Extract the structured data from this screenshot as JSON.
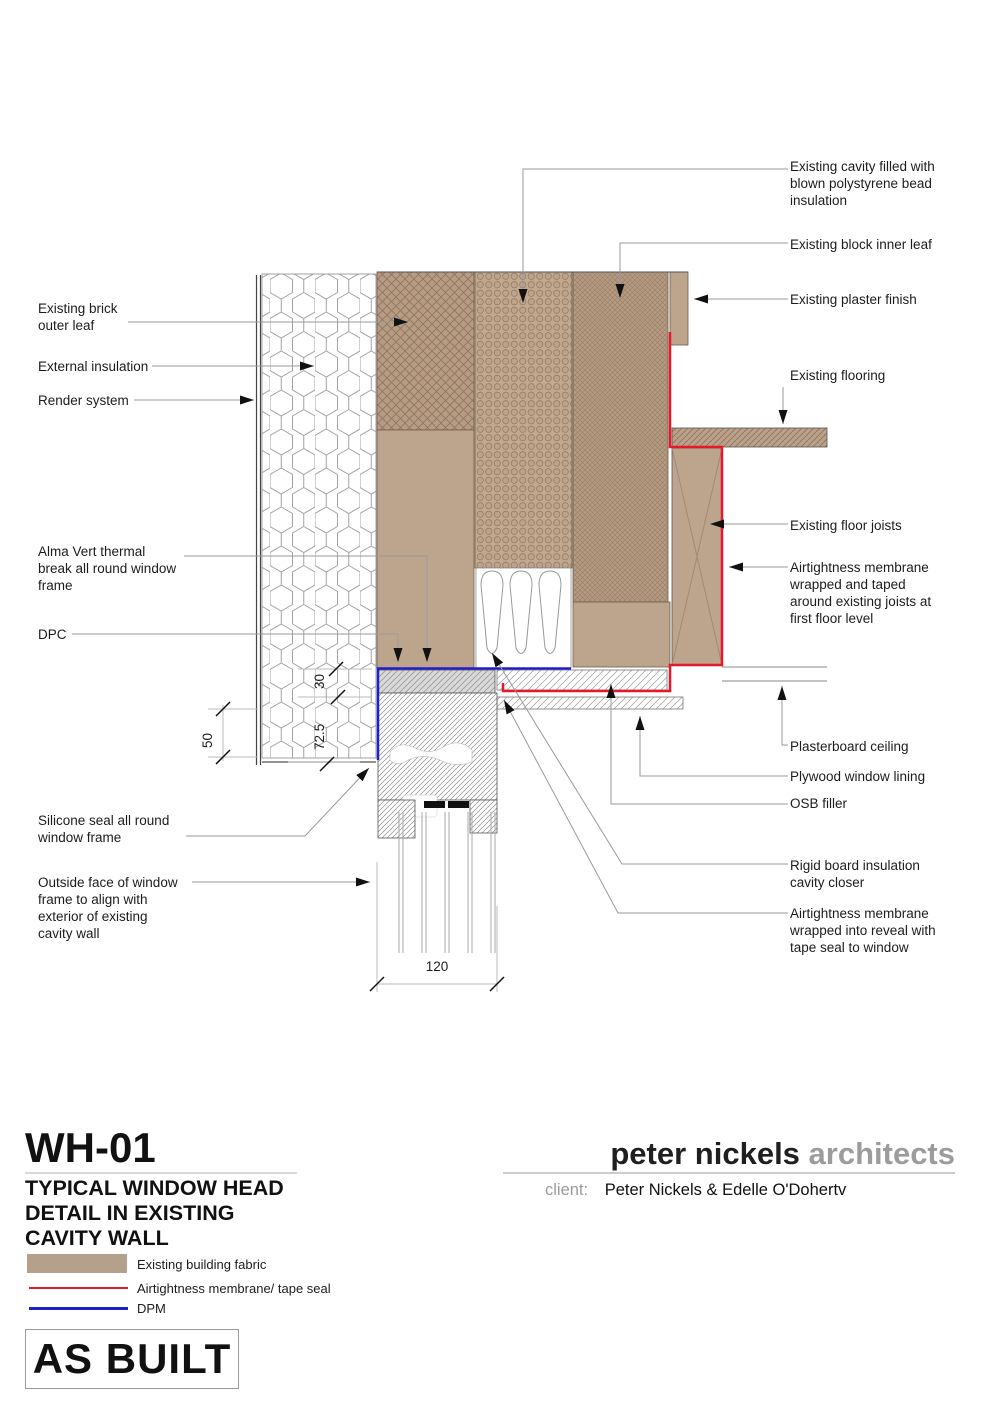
{
  "drawing": {
    "code": "WH-01",
    "title": "TYPICAL WINDOW HEAD\nDETAIL IN EXISTING\nCAVITY WALL",
    "status_stamp": "AS BUILT"
  },
  "branding": {
    "firm_name_black": "peter nickels ",
    "firm_name_gray": "architects",
    "client_label": "client:",
    "client_name": "Peter Nickels & Edelle O'Dohertv"
  },
  "legend": {
    "items": [
      {
        "label": "Existing building fabric",
        "swatch": "#b5a08b",
        "type": "fill-swatch"
      },
      {
        "label": "Airtightness membrane/ tape seal",
        "swatch": "#e8182a",
        "type": "red-line"
      },
      {
        "label": "DPM",
        "swatch": "#2020c8",
        "type": "blue-line"
      }
    ]
  },
  "labels_left": [
    {
      "text": "Existing brick\nouter leaf"
    },
    {
      "text": "External insulation"
    },
    {
      "text": "Render system"
    },
    {
      "text": "Alma Vert thermal\nbreak all round window\nframe"
    },
    {
      "text": "DPC"
    },
    {
      "text": "Silicone seal all round\nwindow frame"
    },
    {
      "text": "Outside face of window\nframe to align with\nexterior of existing\ncavity wall"
    }
  ],
  "labels_right": [
    {
      "text": "Existing cavity filled with\nblown polystyrene bead\ninsulation"
    },
    {
      "text": "Existing block inner leaf"
    },
    {
      "text": "Existing plaster finish"
    },
    {
      "text": "Existing flooring"
    },
    {
      "text": "Existing floor joists"
    },
    {
      "text": "Airtightness membrane\nwrapped and taped\naround existing joists at\nfirst floor level"
    },
    {
      "text": "Plasterboard ceiling"
    },
    {
      "text": "Plywood window lining"
    },
    {
      "text": "OSB filler"
    },
    {
      "text": "Rigid board insulation\ncavity closer"
    },
    {
      "text": "Airtightness membrane\nwrapped into reveal with\ntape seal to window"
    }
  ],
  "dimensions": {
    "d50": "50",
    "d30": "30",
    "d72": "72.5",
    "d120": "120"
  },
  "colors": {
    "existing_fabric": "#b5a08b",
    "airtightness_membrane": "#e8182a",
    "dpm": "#2020c8"
  }
}
